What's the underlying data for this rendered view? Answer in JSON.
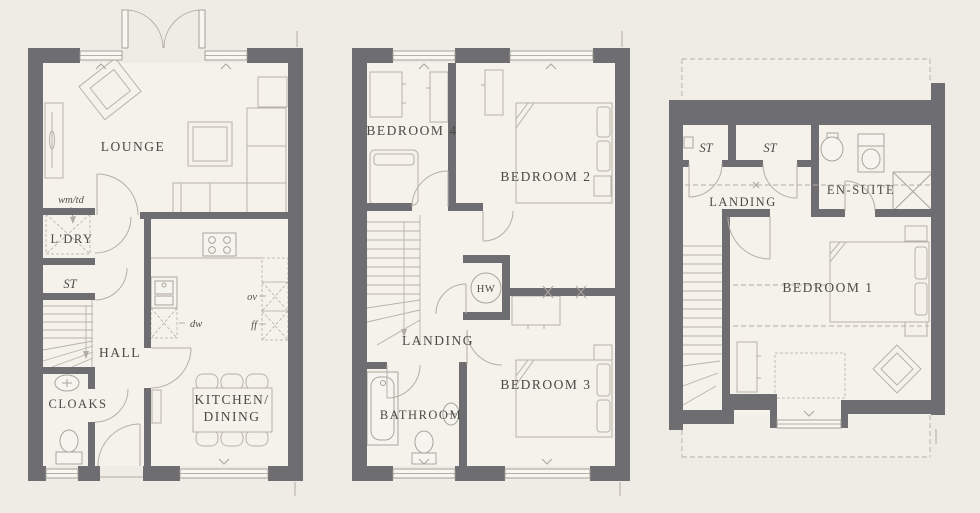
{
  "title": "Three storey house floor plan",
  "colors": {
    "background": "#efece5",
    "floor": "#f4f2eb",
    "wall": "#6e6d71",
    "furniture_line": "#b7b3aa",
    "label_ink": "#4d4945"
  },
  "plans": {
    "ground": {
      "rooms": {
        "lounge": "LOUNGE",
        "laundry": "L'DRY",
        "store": "ST",
        "hall": "HALL",
        "cloaks": "CLOAKS",
        "kitchen_line1": "KITCHEN/",
        "kitchen_line2": "DINING"
      },
      "annotations": {
        "wm_td": "wm/td",
        "dw": "dw",
        "ov": "ov",
        "ff": "ff"
      }
    },
    "first": {
      "rooms": {
        "bedroom4": "BEDROOM 4",
        "bedroom2": "BEDROOM 2",
        "hw": "HW",
        "landing": "LANDING",
        "bathroom": "BATHROOM",
        "bedroom3": "BEDROOM 3"
      }
    },
    "second": {
      "rooms": {
        "store1": "ST",
        "store2": "ST",
        "landing": "LANDING",
        "ensuite": "EN-SUITE",
        "bedroom1": "BEDROOM 1"
      }
    }
  }
}
